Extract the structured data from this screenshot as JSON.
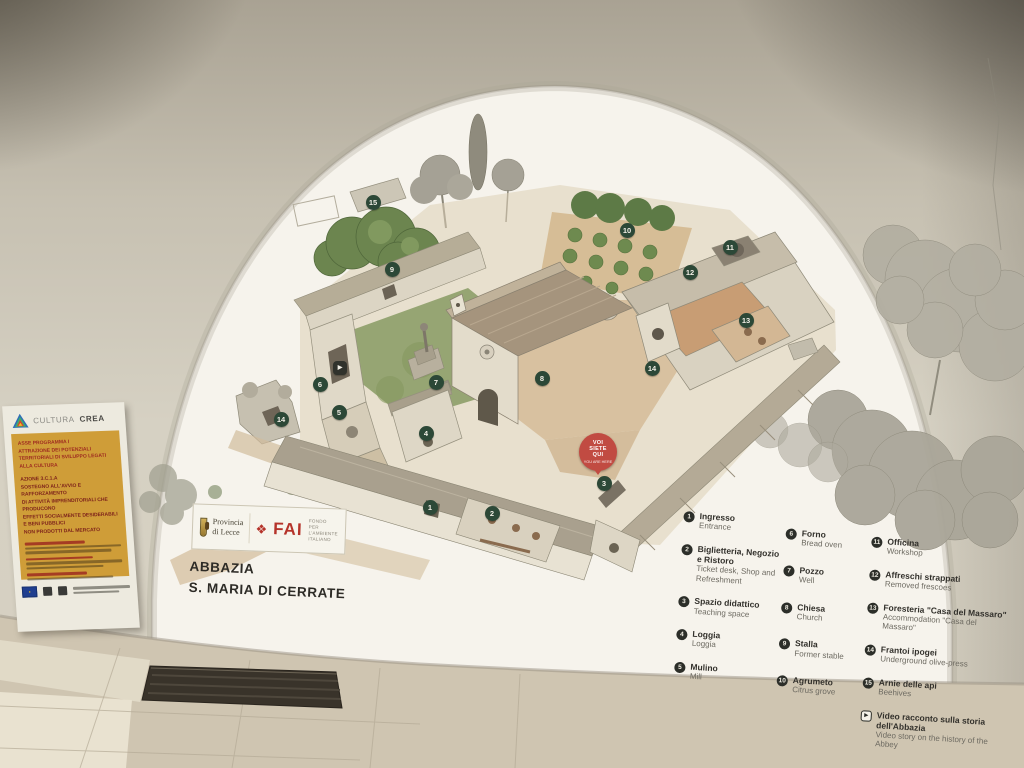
{
  "colors": {
    "marker_green": "#2c4837",
    "pin_red": "#c14b42",
    "poster_yellow": "#cf9d38",
    "poster_red": "#9e2b20",
    "fai_red": "#b5332a"
  },
  "title": {
    "line1": "ABBAZIA",
    "line2": "S. MARIA DI CERRATE"
  },
  "brand": {
    "provincia_line1": "Provincia",
    "provincia_line2": "di Lecce",
    "fai_acronym": "FAI",
    "fai_sub1": "FONDO",
    "fai_sub2": "PER L'AMBIENTE",
    "fai_sub3": "ITALIANO"
  },
  "poster": {
    "brand_light": "CULTURA",
    "brand_bold": "CREA",
    "heading1_lines": [
      "ASSE PROGRAMMA I",
      "ATTRAZIONE DEI POTENZIALI",
      "TERRITORIALI DI SVILUPPO LEGATI",
      "ALLA CULTURA"
    ],
    "heading2_lines": [
      "AZIONE 3.C.1.A",
      "SOSTEGNO ALL'AVVIO E RAFFORZAMENTO",
      "DI ATTIVITÀ IMPRENDITORIALI CHE PRODUCONO",
      "EFFETTI SOCIALMENTE DESIDERABILI E BENI PUBBLICI",
      "NON PRODOTTI DAL MERCATO"
    ]
  },
  "you_are_here": {
    "line1": "VOI",
    "line2": "SIETE",
    "line3": "QUI",
    "sub": "YOU ARE HERE"
  },
  "legend": {
    "columns": [
      [
        {
          "n": "1",
          "it": "Ingresso",
          "en": "Entrance"
        },
        {
          "n": "2",
          "it": "Biglietteria, Negozio e Ristoro",
          "en": "Ticket desk, Shop and Refreshment"
        },
        {
          "n": "3",
          "it": "Spazio didattico",
          "en": "Teaching space"
        },
        {
          "n": "4",
          "it": "Loggia",
          "en": "Loggia"
        },
        {
          "n": "5",
          "it": "Mulino",
          "en": "Mill"
        }
      ],
      [
        {
          "n": "6",
          "it": "Forno",
          "en": "Bread oven"
        },
        {
          "n": "7",
          "it": "Pozzo",
          "en": "Well"
        },
        {
          "n": "8",
          "it": "Chiesa",
          "en": "Church"
        },
        {
          "n": "9",
          "it": "Stalla",
          "en": "Former stable"
        },
        {
          "n": "10",
          "it": "Agrumeto",
          "en": "Citrus grove"
        }
      ],
      [
        {
          "n": "11",
          "it": "Officina",
          "en": "Workshop"
        },
        {
          "n": "12",
          "it": "Affreschi strappati",
          "en": "Removed frescoes"
        },
        {
          "n": "13",
          "it": "Foresteria \"Casa del Massaro\"",
          "en": "Accommodation \"Casa del Massaro\""
        },
        {
          "n": "14",
          "it": "Frantoi ipogei",
          "en": "Underground olive-press"
        },
        {
          "n": "15",
          "it": "Arnie delle api",
          "en": "Beehives"
        },
        {
          "icon": "video",
          "it": "Video racconto sulla storia dell'Abbazia",
          "en": "Video story on the history of the Abbey"
        }
      ]
    ]
  },
  "map": {
    "markers": [
      {
        "n": "1",
        "x": 430,
        "y": 507
      },
      {
        "n": "2",
        "x": 492,
        "y": 513
      },
      {
        "n": "3",
        "x": 604,
        "y": 483
      },
      {
        "n": "4",
        "x": 426,
        "y": 433
      },
      {
        "n": "5",
        "x": 339,
        "y": 412
      },
      {
        "n": "6",
        "x": 320,
        "y": 384
      },
      {
        "n": "7",
        "x": 436,
        "y": 382
      },
      {
        "n": "8",
        "x": 542,
        "y": 378
      },
      {
        "n": "9",
        "x": 392,
        "y": 269
      },
      {
        "n": "10",
        "x": 627,
        "y": 230
      },
      {
        "n": "11",
        "x": 730,
        "y": 247
      },
      {
        "n": "12",
        "x": 690,
        "y": 272
      },
      {
        "n": "13",
        "x": 746,
        "y": 320
      },
      {
        "n": "14",
        "x": 652,
        "y": 368
      },
      {
        "n": "14",
        "x": 281,
        "y": 419
      },
      {
        "n": "15",
        "x": 373,
        "y": 202
      },
      {
        "icon": "video",
        "x": 340,
        "y": 368
      }
    ]
  }
}
